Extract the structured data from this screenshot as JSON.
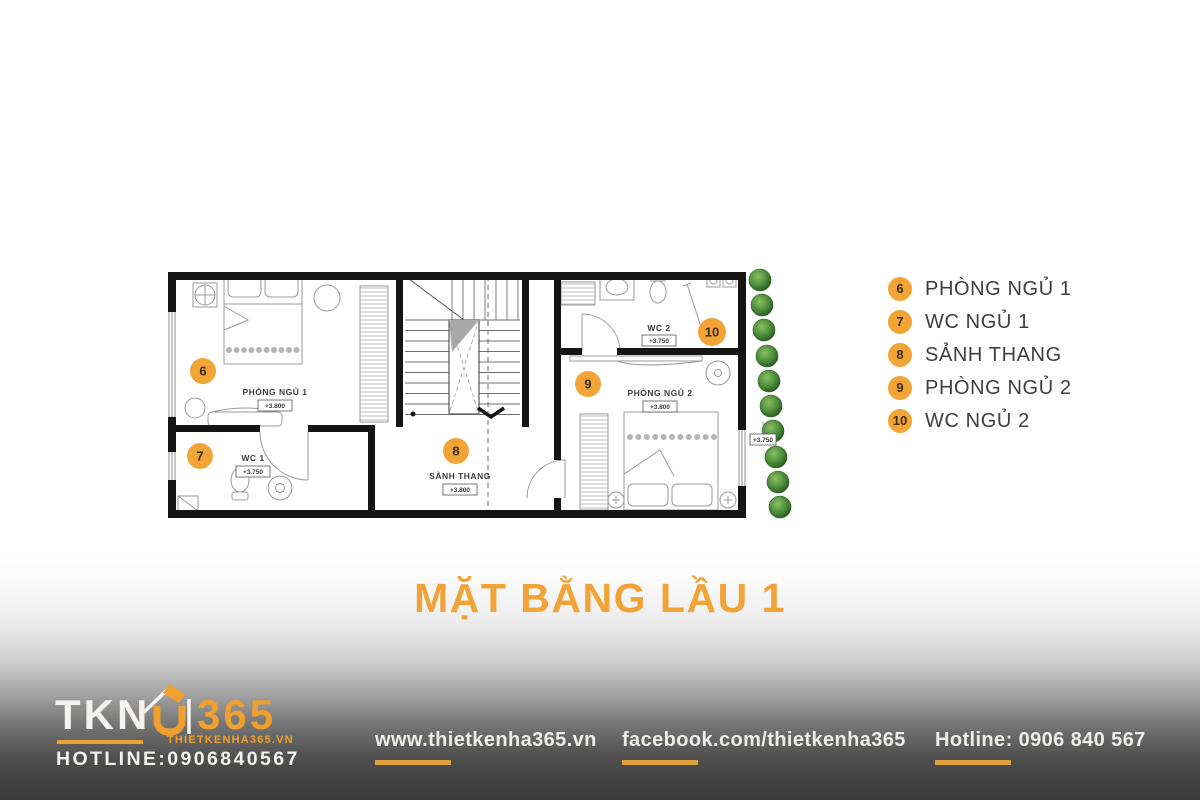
{
  "accent": "#F2A437",
  "title": "MẶT BẰNG LẦU 1",
  "plan": {
    "rooms": [
      {
        "badge": "6",
        "name": "PHÒNG NGỦ 1",
        "elev": "+3.800"
      },
      {
        "badge": "7",
        "name": "WC 1",
        "elev": "+3.750"
      },
      {
        "badge": "8",
        "name": "SẢNH THANG",
        "elev": "+3.800"
      },
      {
        "badge": "9",
        "name": "PHÒNG NGỦ 2",
        "elev": "+3.800"
      },
      {
        "badge": "10",
        "name": "WC 2",
        "elev": "+3.750"
      }
    ],
    "side_elevation": "+3.750"
  },
  "legend": {
    "items": [
      {
        "number": "6",
        "label": "PHÒNG NGỦ 1"
      },
      {
        "number": "7",
        "label": "WC NGỦ 1"
      },
      {
        "number": "8",
        "label": "SẢNH THANG"
      },
      {
        "number": "9",
        "label": "PHÒNG NGỦ 2"
      },
      {
        "number": "10",
        "label": "WC NGỦ 2"
      }
    ]
  },
  "footer": {
    "logo": {
      "brand_left": "TKN",
      "brand_right": "365",
      "website": "THIETKENHA365.VN",
      "hotline": "HOTLINE:0906840567"
    },
    "links": [
      {
        "label": "www.thietkenha365.vn"
      },
      {
        "label": "facebook.com/thietkenha365"
      },
      {
        "label": "Hotline: 0906 840 567"
      }
    ]
  }
}
